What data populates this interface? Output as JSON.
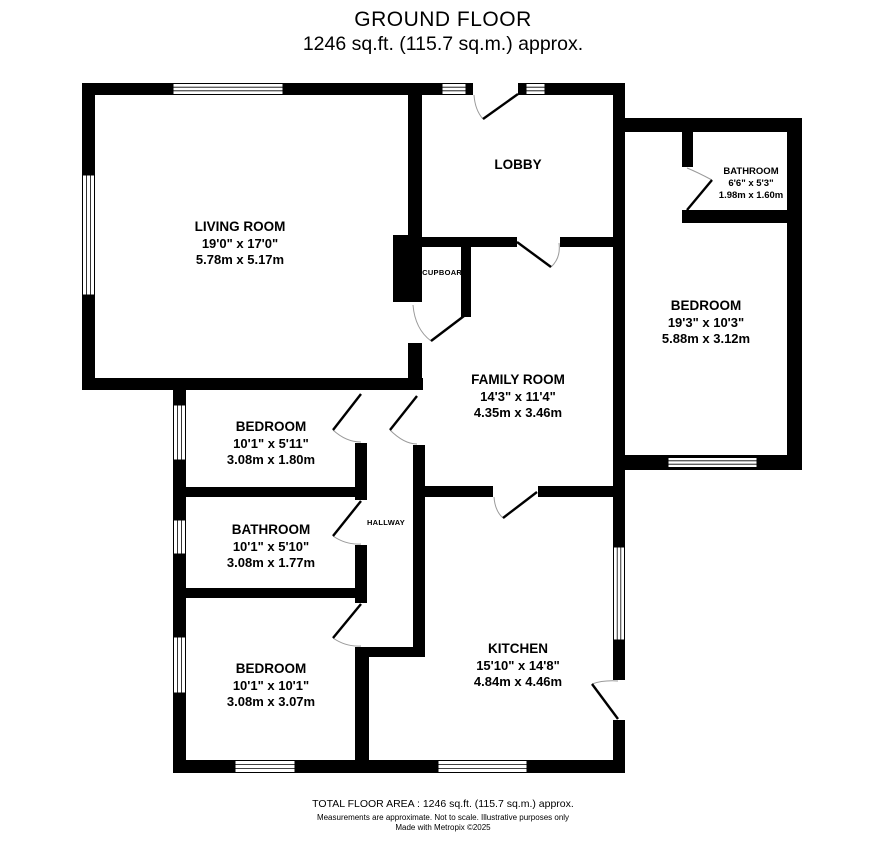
{
  "title": {
    "line1": "GROUND FLOOR",
    "line2": "1246 sq.ft. (115.7 sq.m.) approx."
  },
  "rooms": [
    {
      "name": "LIVING ROOM",
      "dims_ft": "19'0\"  x 17'0\"",
      "dims_m": "5.78m  x 5.17m"
    },
    {
      "name": "LOBBY"
    },
    {
      "name": "BATHROOM",
      "dims_ft": "6'6\"  x 5'3\"",
      "dims_m": "1.98m  x 1.60m"
    },
    {
      "name": "BEDROOM",
      "dims_ft": "19'3\"  x 10'3\"",
      "dims_m": "5.88m  x 3.12m"
    },
    {
      "name": "FAMILY ROOM",
      "dims_ft": "14'3\"  x 11'4\"",
      "dims_m": "4.35m  x 3.46m"
    },
    {
      "name": "BEDROOM",
      "dims_ft": "10'1\"  x 5'11\"",
      "dims_m": "3.08m  x 1.80m"
    },
    {
      "name": "BATHROOM",
      "dims_ft": "10'1\"  x 5'10\"",
      "dims_m": "3.08m  x 1.77m"
    },
    {
      "name": "BEDROOM",
      "dims_ft": "10'1\"  x 10'1\"",
      "dims_m": "3.08m  x 3.07m"
    },
    {
      "name": "KITCHEN",
      "dims_ft": "15'10\"  x 14'8\"",
      "dims_m": "4.84m  x 4.46m"
    }
  ],
  "labels": {
    "cupboard": "CUPBOARD",
    "hallway": "HALLWAY"
  },
  "footer": {
    "area": "TOTAL FLOOR AREA : 1246 sq.ft. (115.7 sq.m.) approx.",
    "disclaimer": "Measurements are approximate.  Not to scale.  Illustrative purposes only",
    "credit": "Made with Metropix ©2025"
  },
  "colors": {
    "wall": "#000000",
    "background": "#ffffff",
    "door_arc": "#9a9a9a"
  }
}
